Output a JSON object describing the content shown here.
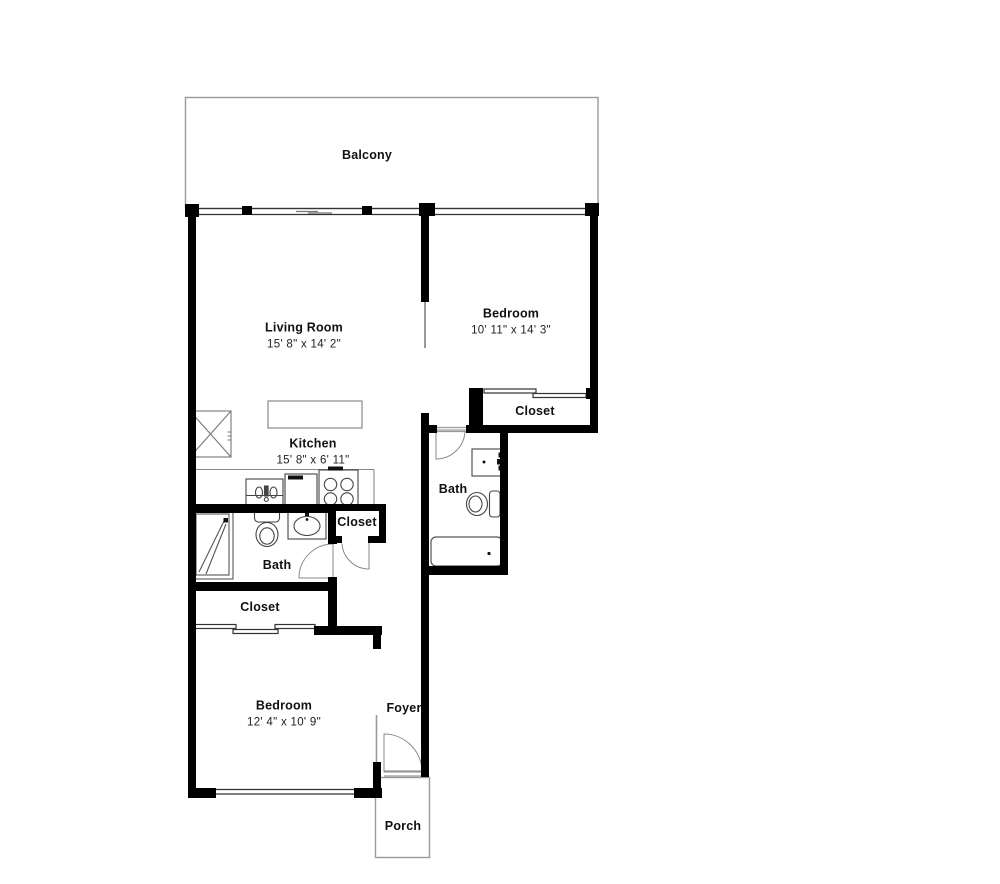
{
  "title": "Two bedroom apartment floor plan",
  "colors": {
    "wall": "#000000",
    "fixture_line": "#444444",
    "light_outline": "#9a9a9a",
    "background": "#ffffff",
    "text": "#111111"
  },
  "floor_plan": {
    "balcony": {
      "name": "Balcony"
    },
    "living_room": {
      "name": "Living Room",
      "dims": "15' 8\" x 14' 2\""
    },
    "bedroom_1": {
      "name": "Bedroom",
      "dims": "10' 11\" x 14' 3\""
    },
    "bedroom_1_closet": {
      "name": "Closet"
    },
    "kitchen": {
      "name": "Kitchen",
      "dims": "15' 8\" x 6' 11\""
    },
    "bath_1": {
      "name": "Bath"
    },
    "bath_2": {
      "name": "Bath"
    },
    "hall_closet": {
      "name": "Closet"
    },
    "bedroom_2_closet": {
      "name": "Closet"
    },
    "bedroom_2": {
      "name": "Bedroom",
      "dims": "12' 4\" x 10' 9\""
    },
    "foyer": {
      "name": "Foyer"
    },
    "porch": {
      "name": "Porch"
    }
  }
}
